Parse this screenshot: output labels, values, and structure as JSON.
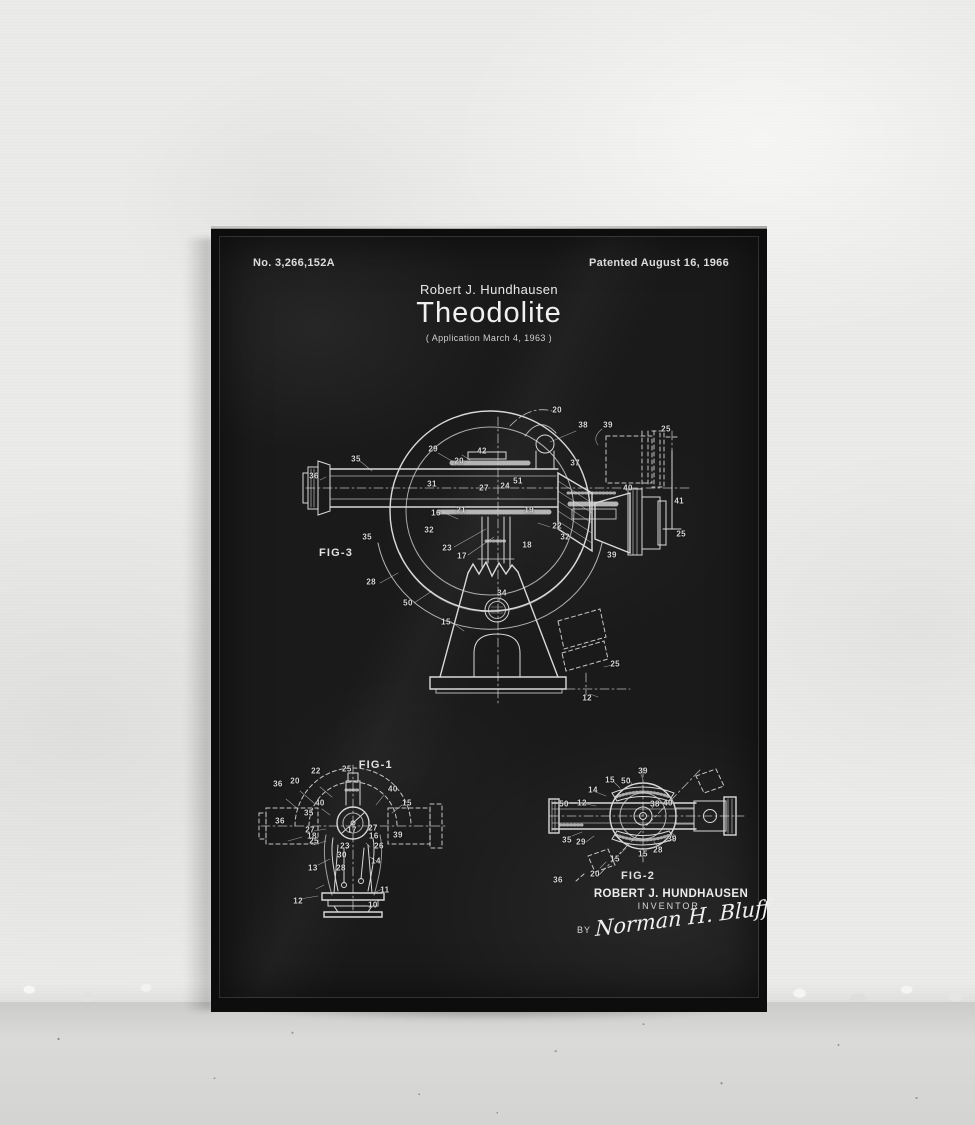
{
  "poster": {
    "patent_number": "No. 3,266,152A",
    "patent_date": "Patented August 16, 1966",
    "inventor_line": "Robert J. Hundhausen",
    "title": "Theodolite",
    "application_line": "( Application  March 4, 1963 )",
    "figures": [
      {
        "id": "fig-3",
        "label": "FIG-3",
        "callouts": [
          {
            "n": "20",
            "x": 64.3,
            "y": 8.8
          },
          {
            "n": "38",
            "x": 70.8,
            "y": 13.3
          },
          {
            "n": "39",
            "x": 77.0,
            "y": 13.3
          },
          {
            "n": "25",
            "x": 91.5,
            "y": 14.5
          },
          {
            "n": "29",
            "x": 33.3,
            "y": 20.6
          },
          {
            "n": "42",
            "x": 45.5,
            "y": 21.2
          },
          {
            "n": "20",
            "x": 39.8,
            "y": 24.2
          },
          {
            "n": "35",
            "x": 14.0,
            "y": 23.6
          },
          {
            "n": "37",
            "x": 68.8,
            "y": 24.8
          },
          {
            "n": "36",
            "x": 3.5,
            "y": 28.8
          },
          {
            "n": "31",
            "x": 33.0,
            "y": 31.2
          },
          {
            "n": "51",
            "x": 54.5,
            "y": 30.3
          },
          {
            "n": "24",
            "x": 51.3,
            "y": 31.8
          },
          {
            "n": "27",
            "x": 46.0,
            "y": 32.4
          },
          {
            "n": "40",
            "x": 82.0,
            "y": 32.4
          },
          {
            "n": "41",
            "x": 94.8,
            "y": 36.4
          },
          {
            "n": "21",
            "x": 40.3,
            "y": 39.1
          },
          {
            "n": "16",
            "x": 34.0,
            "y": 40.0
          },
          {
            "n": "19",
            "x": 57.3,
            "y": 39.1
          },
          {
            "n": "22",
            "x": 64.3,
            "y": 43.9
          },
          {
            "n": "32",
            "x": 32.3,
            "y": 45.2
          },
          {
            "n": "35",
            "x": 16.8,
            "y": 47.3
          },
          {
            "n": "25",
            "x": 95.3,
            "y": 46.4
          },
          {
            "n": "32",
            "x": 66.3,
            "y": 47.3
          },
          {
            "n": "23",
            "x": 36.8,
            "y": 50.6
          },
          {
            "n": "18",
            "x": 56.8,
            "y": 49.7
          },
          {
            "n": "17",
            "x": 40.5,
            "y": 53.0
          },
          {
            "n": "39",
            "x": 78.0,
            "y": 52.7
          },
          {
            "n": "28",
            "x": 17.8,
            "y": 60.9
          },
          {
            "n": "50",
            "x": 27.0,
            "y": 67.3
          },
          {
            "n": "34",
            "x": 50.5,
            "y": 64.2
          },
          {
            "n": "15",
            "x": 36.5,
            "y": 73.0
          },
          {
            "n": "25",
            "x": 78.8,
            "y": 85.8
          },
          {
            "n": "12",
            "x": 71.8,
            "y": 96.1
          }
        ]
      },
      {
        "id": "fig-1",
        "label": "FIG-1",
        "callouts": [
          {
            "n": "22",
            "x": 30.5,
            "y": 10.9
          },
          {
            "n": "25",
            "x": 46.8,
            "y": 9.7
          },
          {
            "n": "20",
            "x": 19.5,
            "y": 17.0
          },
          {
            "n": "36",
            "x": 10.5,
            "y": 18.8
          },
          {
            "n": "40",
            "x": 71.0,
            "y": 21.8
          },
          {
            "n": "40",
            "x": 32.6,
            "y": 30.3
          },
          {
            "n": "15",
            "x": 78.4,
            "y": 30.3
          },
          {
            "n": "35",
            "x": 26.8,
            "y": 36.4
          },
          {
            "n": "36",
            "x": 11.6,
            "y": 41.2
          },
          {
            "n": "27",
            "x": 27.4,
            "y": 46.7
          },
          {
            "n": "17",
            "x": 49.5,
            "y": 46.7
          },
          {
            "n": "27",
            "x": 60.5,
            "y": 45.5
          },
          {
            "n": "18",
            "x": 28.4,
            "y": 50.3
          },
          {
            "n": "16",
            "x": 61.0,
            "y": 50.3
          },
          {
            "n": "39",
            "x": 73.7,
            "y": 49.7
          },
          {
            "n": "25",
            "x": 29.5,
            "y": 53.3
          },
          {
            "n": "23",
            "x": 45.8,
            "y": 56.4
          },
          {
            "n": "26",
            "x": 63.7,
            "y": 56.4
          },
          {
            "n": "30",
            "x": 44.2,
            "y": 61.8
          },
          {
            "n": "14",
            "x": 62.1,
            "y": 65.5
          },
          {
            "n": "13",
            "x": 28.9,
            "y": 69.7
          },
          {
            "n": "28",
            "x": 43.7,
            "y": 69.7
          },
          {
            "n": "11",
            "x": 66.8,
            "y": 83.0
          },
          {
            "n": "12",
            "x": 21.1,
            "y": 89.7
          },
          {
            "n": "10",
            "x": 60.5,
            "y": 92.1
          }
        ]
      },
      {
        "id": "fig-2",
        "label": "FIG-2",
        "callouts": [
          {
            "n": "39",
            "x": 47.5,
            "y": 5.8
          },
          {
            "n": "15",
            "x": 31.0,
            "y": 13.3
          },
          {
            "n": "50",
            "x": 39.0,
            "y": 14.2
          },
          {
            "n": "14",
            "x": 22.5,
            "y": 21.7
          },
          {
            "n": "12",
            "x": 17.0,
            "y": 32.5
          },
          {
            "n": "50",
            "x": 8.0,
            "y": 33.3
          },
          {
            "n": "38",
            "x": 53.5,
            "y": 33.3
          },
          {
            "n": "40",
            "x": 60.0,
            "y": 32.5
          },
          {
            "n": "35",
            "x": 9.5,
            "y": 63.3
          },
          {
            "n": "29",
            "x": 16.5,
            "y": 65.0
          },
          {
            "n": "39",
            "x": 62.0,
            "y": 62.5
          },
          {
            "n": "28",
            "x": 55.0,
            "y": 71.7
          },
          {
            "n": "15",
            "x": 47.5,
            "y": 75.0
          },
          {
            "n": "15",
            "x": 33.5,
            "y": 79.2
          },
          {
            "n": "20",
            "x": 23.5,
            "y": 91.7
          },
          {
            "n": "36",
            "x": 5.0,
            "y": 96.7
          }
        ]
      }
    ],
    "signature_block": {
      "name": "ROBERT  J. HUNDHAUSEN",
      "role": "INVENTOR.",
      "by_label": "BY",
      "signature": "Norman H. Bluff"
    },
    "colors": {
      "poster_background": "#1a1a1a",
      "ink": "#e4e4e4",
      "frame": "#0d0d0d",
      "wall": "#ebebe9",
      "floor": "#d8d8d6"
    }
  }
}
